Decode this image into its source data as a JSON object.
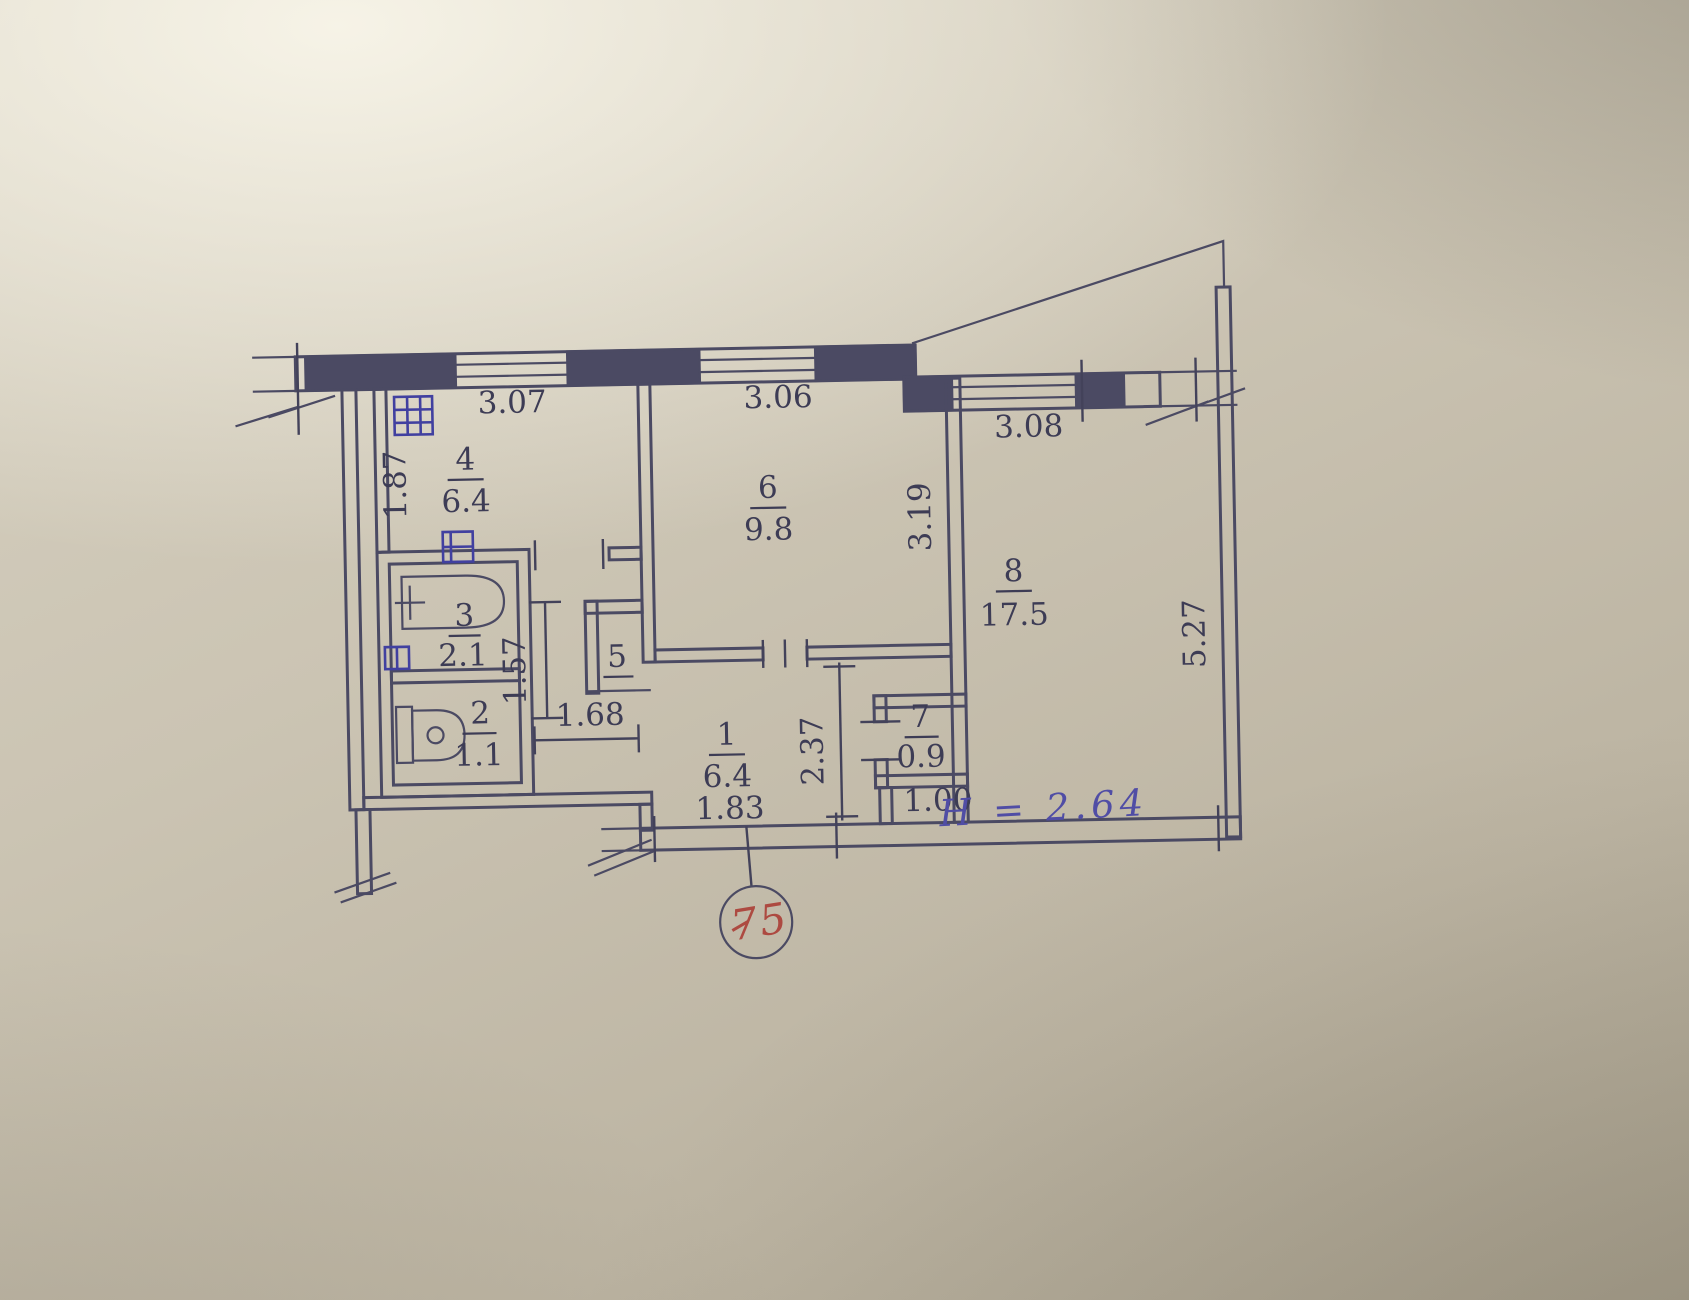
{
  "document": {
    "type": "apartment-floor-plan-technical-drawing",
    "apartment_number": "75",
    "ceiling_height_note": "H = 2.64"
  },
  "rooms": {
    "r1": {
      "number": "1",
      "area": "6.4"
    },
    "r2": {
      "number": "2",
      "area": "1.1"
    },
    "r3": {
      "number": "3",
      "area": "2.1"
    },
    "r4": {
      "number": "4",
      "area": "6.4"
    },
    "r5": {
      "number": "5"
    },
    "r6": {
      "number": "6",
      "area": "9.8"
    },
    "r7": {
      "number": "7",
      "area": "0.9"
    },
    "r8": {
      "number": "8",
      "area": "17.5"
    }
  },
  "dimensions": {
    "d307": "3.07",
    "d306": "3.06",
    "d308": "3.08",
    "d187": "1.87",
    "d319": "3.19",
    "d527": "5.27",
    "d157": "1.57",
    "d168": "1.68",
    "d237": "2.37",
    "d100": "1.00",
    "d183": "1.83"
  },
  "colors": {
    "paper": "#c9c2b1",
    "ink": "#4b4a63",
    "vent_icon_blue": "#4140a0",
    "annotation_red": "#ad4a41",
    "handwriting_blue": "#504da5"
  }
}
